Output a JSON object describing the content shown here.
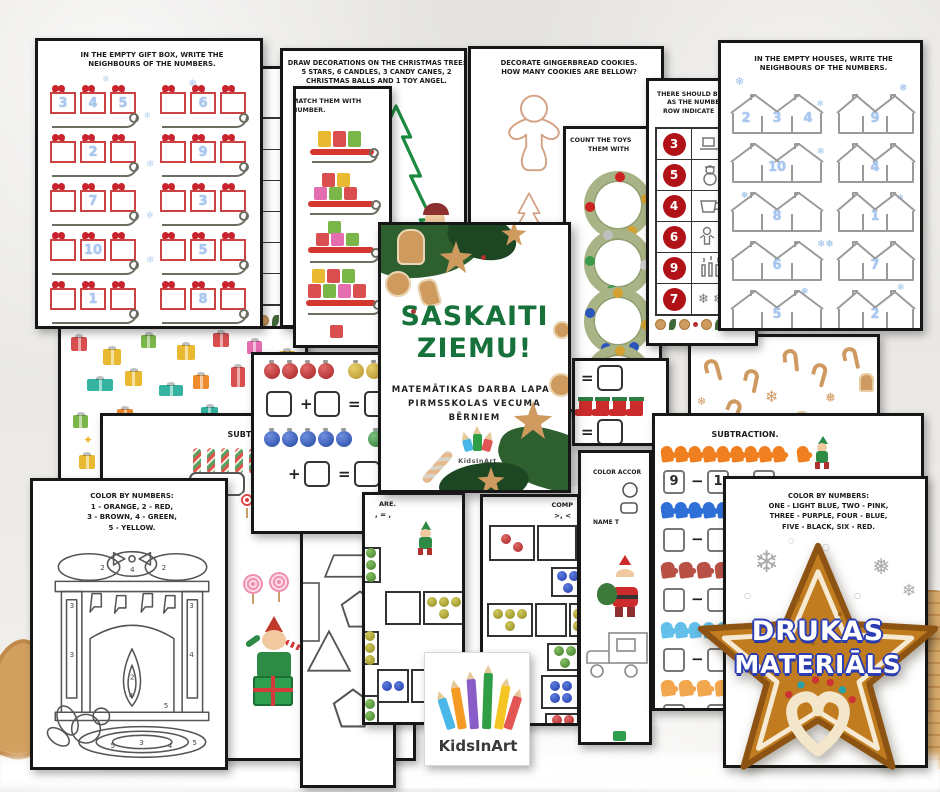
{
  "colors": {
    "cover_green": "#17713a",
    "badge_brown": "#c07c1e",
    "badge_outline_blue": "#2b3eb5",
    "number_blue": "#a9c7ef",
    "circle_red": "#b01217",
    "bow_red": "#c9242e"
  },
  "badge": {
    "line1": "DRUKAS",
    "line2": "MATERIĀLS"
  },
  "cover": {
    "title1": "SASKAITI",
    "title2": "ZIEMU!",
    "sub1": "MATEMĀTIKAS DARBA LAPAS",
    "sub2": "PIRMSSKOLAS VECUMA",
    "sub3": "BĒRNIEM",
    "brand": "KidsInArt"
  },
  "card": {
    "brand": "KidsInArt"
  },
  "ops": {
    "plus": "+",
    "minus": "−",
    "equals": "="
  },
  "ws": {
    "gift_box": {
      "title1": "IN THE EMPTY GIFT BOX, WRITE THE",
      "title2": "NEIGHBOURS OF THE NUMBERS.",
      "sleds": [
        {
          "c": [
            "3",
            "4",
            "5"
          ]
        },
        {
          "c": [
            "",
            "6",
            ""
          ]
        },
        {
          "c": [
            "",
            "2",
            ""
          ]
        },
        {
          "c": [
            "",
            "9",
            ""
          ]
        },
        {
          "c": [
            "",
            "7",
            ""
          ]
        },
        {
          "c": [
            "",
            "3",
            ""
          ]
        },
        {
          "c": [
            "",
            "10",
            ""
          ]
        },
        {
          "c": [
            "",
            "5",
            ""
          ]
        },
        {
          "c": [
            "",
            "1",
            ""
          ]
        },
        {
          "c": [
            "",
            "8",
            ""
          ]
        }
      ]
    },
    "row_items": {
      "t1": "S IN THE ROW",
      "t2": "NING OF THE",
      "t3": "SSING ITEMS."
    },
    "tree": {
      "title1": "DRAW DECORATIONS ON THE CHRISTMAS TREE:",
      "title2": "5 STARS, 6 CANDLES, 3 CANDY CANES, 2",
      "title3": "CHRISTMAS BALLS AND 1 TOY ANGEL."
    },
    "match": {
      "t1": "MATCH THEM WITH",
      "t2": "NUMBER."
    },
    "gingerbread": {
      "title1": "DECORATE GINGERBREAD COOKIES.",
      "title2": "HOW MANY COOKIES ARE BELLOW?"
    },
    "wreaths": {
      "t1": "COUNT THE TOYS",
      "t2": "THEM WITH"
    },
    "count_rows": {
      "t1": "THERE SHOULD B",
      "t2": "AS THE NUMBE",
      "t3": "ROW INDICATE",
      "rows": [
        {
          "n": "3",
          "icon": "sled"
        },
        {
          "n": "5",
          "icon": "snowman"
        },
        {
          "n": "4",
          "icon": "cup"
        },
        {
          "n": "6",
          "icon": "gingerbread-man"
        },
        {
          "n": "9",
          "icon": "candles"
        },
        {
          "n": "7",
          "icon": "snowflakes"
        }
      ],
      "snowflake_glyphs": "❄ ❄"
    },
    "houses": {
      "title1": "IN THE EMPTY HOUSES, WRITE THE",
      "title2": "NEIGHBOURS OF THE NUMBERS.",
      "rows": [
        {
          "c": [
            "2",
            "3",
            "4"
          ]
        },
        {
          "c": [
            "",
            "9",
            ""
          ]
        },
        {
          "c": [
            "",
            "10",
            ""
          ]
        },
        {
          "c": [
            "",
            "4",
            ""
          ]
        },
        {
          "c": [
            "",
            "8",
            ""
          ]
        },
        {
          "c": [
            "",
            "1",
            ""
          ]
        },
        {
          "c": [
            "",
            "6",
            ""
          ]
        },
        {
          "c": [
            "",
            "7",
            ""
          ]
        },
        {
          "c": [
            "",
            "5",
            ""
          ]
        },
        {
          "c": [
            "",
            "2",
            ""
          ]
        }
      ]
    },
    "sub_left": {
      "title": "SUBTRACTION."
    },
    "sub_right": {
      "title": "SUBTRACTION.",
      "minuend": "9",
      "subtrahend": "1"
    },
    "shapes": {
      "lines": [
        "METRIC SHAPES:",
        "IN,",
        "LUE,",
        "D,",
        "OWN,",
        "GE,",
        "LOW,",
        "RPLE.",
        "TRICAL SHAPES."
      ]
    },
    "compare_left": {
      "title": "ARE.",
      "symbols": ", = ,"
    },
    "compare_right": {
      "title": "COMP",
      "symbols": ">, <"
    },
    "santa": {
      "t1": "COLOR ACCOR",
      "t2": "NAME T"
    },
    "fireplace": {
      "title1": "COLOR BY NUMBERS:",
      "title2": "1 - ORANGE, 2 - RED,",
      "title3": "3 - BROWN, 4 - GREEN,",
      "title4": "5 - YELLOW."
    },
    "color_star": {
      "title1": "COLOR BY NUMBERS:",
      "title2": "ONE - LIGHT BLUE, TWO - PINK,",
      "title3": "THREE - PURPLE, FOUR - BLUE,",
      "title4": "FIVE - BLACK, SIX - RED."
    }
  }
}
